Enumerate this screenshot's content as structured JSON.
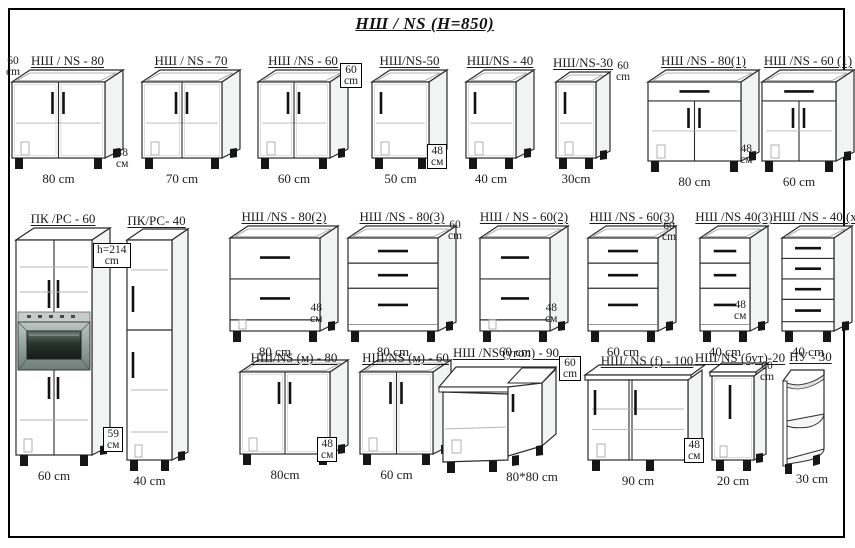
{
  "title": "НШ / NS  (H=850)",
  "figures": {
    "cabinets": [
      {
        "id": "ns-80",
        "label": "НШ / NS - 80",
        "width_label": "80 cm",
        "type": "door2",
        "x": 12,
        "y": 82,
        "w": 93,
        "h": 76
      },
      {
        "id": "ns-70",
        "label": "НШ / NS - 70",
        "width_label": "70 cm",
        "type": "door2",
        "x": 142,
        "y": 82,
        "w": 80,
        "h": 76
      },
      {
        "id": "ns-60",
        "label": "НШ /NS - 60",
        "width_label": "60 cm",
        "type": "door2",
        "x": 258,
        "y": 82,
        "w": 72,
        "h": 76
      },
      {
        "id": "ns-50",
        "label": "НШ/NS-50",
        "width_label": "50 cm",
        "type": "door1",
        "x": 372,
        "y": 82,
        "w": 57,
        "h": 76
      },
      {
        "id": "ns-40",
        "label": "НШ/NS - 40",
        "width_label": "40 cm",
        "type": "door1",
        "x": 466,
        "y": 82,
        "w": 50,
        "h": 76
      },
      {
        "id": "ns-30",
        "label": "НШ/NS-30",
        "width_label": "30cm",
        "type": "door1",
        "x": 556,
        "y": 82,
        "w": 40,
        "h": 76
      },
      {
        "id": "ns-80-1",
        "label": "НШ /NS - 80(1)",
        "width_label": "80 cm",
        "type": "drawer1door2",
        "x": 648,
        "y": 82,
        "w": 93,
        "h": 79
      },
      {
        "id": "ns-60-1",
        "label": "НШ /NS - 60 (1)",
        "width_label": "60 cm",
        "type": "drawer1door2",
        "x": 762,
        "y": 82,
        "w": 74,
        "h": 79
      },
      {
        "id": "pk-60",
        "label": "ПК /РС - 60",
        "width_label": "60 cm",
        "type": "tall_oven",
        "x": 16,
        "y": 240,
        "w": 76,
        "h": 215
      },
      {
        "id": "pk-40",
        "label": "ПК/РС- 40",
        "width_label": "40 cm",
        "type": "tall_narrow",
        "x": 127,
        "y": 240,
        "w": 45,
        "h": 220
      },
      {
        "id": "ns-80-2",
        "label": "НШ /NS - 80(2)",
        "width_label": "80 cm",
        "type": "drawers2",
        "x": 230,
        "y": 238,
        "w": 90,
        "h": 93
      },
      {
        "id": "ns-80-3",
        "label": "НШ /NS - 80(3)",
        "width_label": "80 cm",
        "type": "drawers3",
        "x": 348,
        "y": 238,
        "w": 90,
        "h": 93
      },
      {
        "id": "ns-60-2",
        "label": "НШ / NS - 60(2)",
        "width_label": "60 cm",
        "type": "drawers2",
        "x": 480,
        "y": 238,
        "w": 70,
        "h": 93
      },
      {
        "id": "ns-60-3",
        "label": "НШ /NS - 60(3)",
        "width_label": "60 cm",
        "type": "drawers3",
        "x": 588,
        "y": 238,
        "w": 70,
        "h": 93
      },
      {
        "id": "ns-40-3",
        "label": "НШ /NS 40(3)",
        "width_label": "40 cm",
        "type": "drawers3",
        "x": 700,
        "y": 238,
        "w": 50,
        "h": 93
      },
      {
        "id": "ns-40-x",
        "label": "НШ /NS - 40 (x)",
        "width_label": "40 cm",
        "type": "drawers4",
        "x": 782,
        "y": 238,
        "w": 52,
        "h": 93
      },
      {
        "id": "ns-m-80",
        "label": "НШ/NS (м) - 80",
        "width_label": "80cm",
        "type": "sink2",
        "x": 240,
        "y": 372,
        "w": 90,
        "h": 82
      },
      {
        "id": "ns-m-60",
        "label": "НШ/NS (м) - 60",
        "width_label": "60 cm",
        "type": "sink2",
        "x": 360,
        "y": 372,
        "w": 73,
        "h": 82
      },
      {
        "id": "ns-ugol-90",
        "label": "НШ /NS (угол) - 90",
        "width_label": "80*80 cm",
        "type": "corner",
        "x": 439,
        "y": 367,
        "w": 125,
        "h": 96
      },
      {
        "id": "ns-f-100",
        "label": "НШ/ NS (f) - 100",
        "width_label": "90 cm",
        "type": "door2f",
        "x": 588,
        "y": 375,
        "w": 100,
        "h": 85
      },
      {
        "id": "ns-but-20",
        "label": "НШ/NS (бут)-20",
        "width_label": "20 cm",
        "type": "narrow1",
        "x": 712,
        "y": 372,
        "w": 42,
        "h": 88
      },
      {
        "id": "nu-30",
        "label": "НУ - 30",
        "width_label": "30 cm",
        "type": "open_corner",
        "x": 783,
        "y": 371,
        "w": 41,
        "h": 95
      }
    ],
    "dimension_labels": [
      {
        "id": "d1",
        "lines": [
          "60",
          "cm"
        ],
        "x": 6,
        "y": 56,
        "boxed": false
      },
      {
        "id": "d2",
        "lines": [
          "48",
          "см"
        ],
        "x": 116,
        "y": 148,
        "boxed": false
      },
      {
        "id": "d3",
        "lines": [
          "60",
          "cm"
        ],
        "x": 340,
        "y": 63,
        "boxed": true
      },
      {
        "id": "d4",
        "lines": [
          "48",
          "см"
        ],
        "x": 427,
        "y": 144,
        "boxed": true
      },
      {
        "id": "d5",
        "lines": [
          "60",
          "cm"
        ],
        "x": 616,
        "y": 61,
        "boxed": false
      },
      {
        "id": "d6",
        "lines": [
          "48",
          "см"
        ],
        "x": 740,
        "y": 144,
        "boxed": false
      },
      {
        "id": "d7",
        "lines": [
          "h=214",
          "cm"
        ],
        "x": 93,
        "y": 243,
        "boxed": true
      },
      {
        "id": "d8",
        "lines": [
          "59",
          "см"
        ],
        "x": 103,
        "y": 427,
        "boxed": true
      },
      {
        "id": "d9",
        "lines": [
          "48",
          "см"
        ],
        "x": 310,
        "y": 303,
        "boxed": false
      },
      {
        "id": "d10",
        "lines": [
          "60",
          "cm"
        ],
        "x": 448,
        "y": 220,
        "boxed": false
      },
      {
        "id": "d11",
        "lines": [
          "48",
          "см"
        ],
        "x": 545,
        "y": 303,
        "boxed": false
      },
      {
        "id": "d12",
        "lines": [
          "60",
          "cm"
        ],
        "x": 662,
        "y": 221,
        "boxed": false
      },
      {
        "id": "d13",
        "lines": [
          "48",
          "см"
        ],
        "x": 734,
        "y": 300,
        "boxed": false
      },
      {
        "id": "d14",
        "lines": [
          "48",
          "см"
        ],
        "x": 317,
        "y": 437,
        "boxed": true
      },
      {
        "id": "d15",
        "lines": [
          "60",
          "cm"
        ],
        "x": 559,
        "y": 356,
        "boxed": true
      },
      {
        "id": "d16",
        "lines": [
          "48",
          "см"
        ],
        "x": 684,
        "y": 438,
        "boxed": true
      },
      {
        "id": "d17",
        "lines": [
          "60",
          "cm"
        ],
        "x": 760,
        "y": 361,
        "boxed": false
      }
    ]
  }
}
